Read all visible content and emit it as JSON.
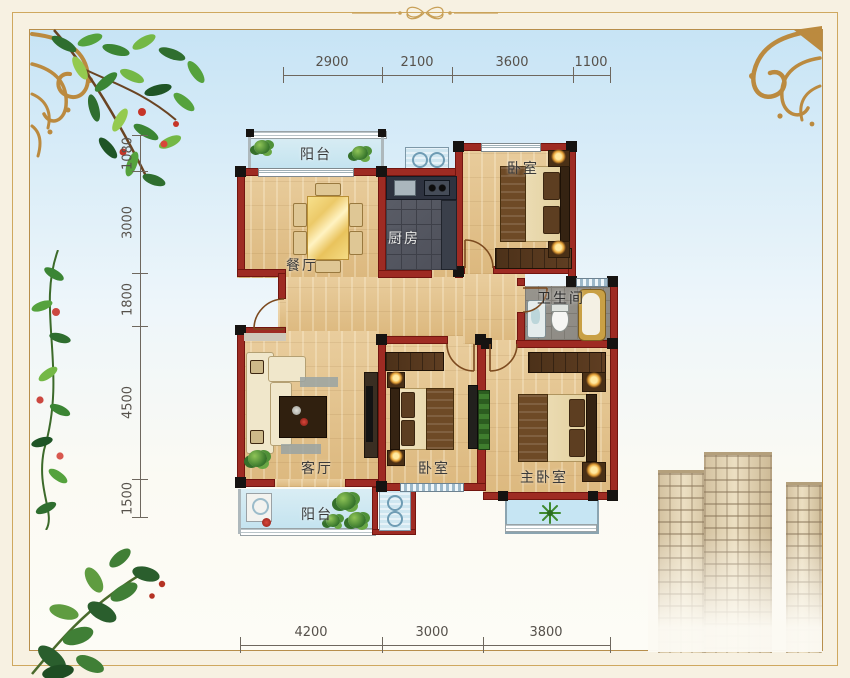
{
  "floorplan": {
    "wall_color": "#9e2b23",
    "rooms": {
      "balcony_top": {
        "label": "阳台"
      },
      "dining": {
        "label": "餐厅"
      },
      "kitchen": {
        "label": "厨房"
      },
      "bedroom_top": {
        "label": "卧室"
      },
      "bathroom": {
        "label": "卫生间"
      },
      "living": {
        "label": "客厅"
      },
      "bedroom_mid": {
        "label": "卧室"
      },
      "master": {
        "label": "主卧室"
      },
      "balcony_bottom": {
        "label": "阳台"
      }
    },
    "dimensions": {
      "top": [
        "2900",
        "2100",
        "3600",
        "1100"
      ],
      "left": [
        "1080",
        "3000",
        "1800",
        "4500",
        "1500"
      ],
      "bottom": [
        "4200",
        "3000",
        "3800"
      ]
    }
  },
  "palette": {
    "frame_gold": "#c19a5b",
    "sky_top": "#c7e4f5",
    "wall_red": "#9e2b23",
    "wood_floor": "#e2c18c",
    "kitchen_tile": "#565963",
    "bath_tile": "#92908a",
    "balcony_glass": "#cfe8f0"
  }
}
